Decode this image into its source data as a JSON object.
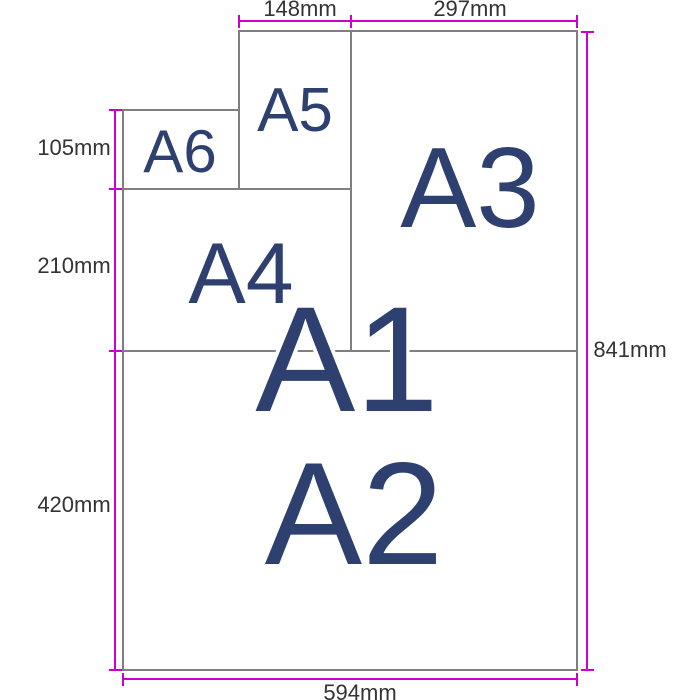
{
  "paper_labels": {
    "a1": "A1",
    "a2": "A2",
    "a3": "A3",
    "a4": "A4",
    "a5": "A5",
    "a6": "A6"
  },
  "dimension_labels": {
    "a5_width": "148mm",
    "a3_width": "297mm",
    "a6_height": "105mm",
    "a4_height": "210mm",
    "a2_height": "420mm",
    "a1_height": "841mm",
    "a1_width": "594mm"
  },
  "colors": {
    "dimension_line": "#cc00cc",
    "paper_border": "#7f7f7f",
    "paper_label_text": "#2e4070",
    "dimension_label_text": "#333333",
    "background": "#ffffff"
  }
}
